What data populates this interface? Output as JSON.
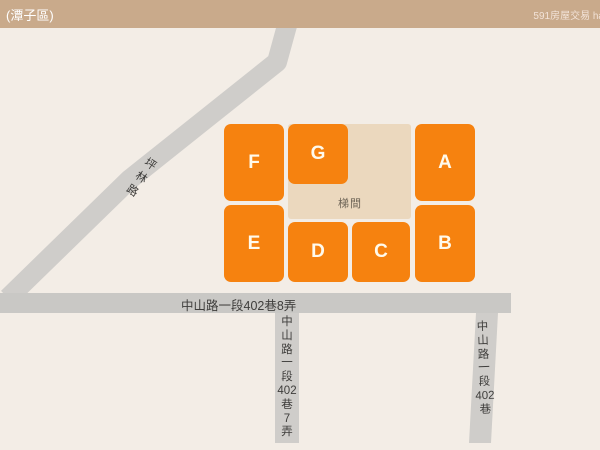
{
  "header": {
    "title": "(潭子區)",
    "watermark": "591房屋交易 ha"
  },
  "map": {
    "stairwell_label": "梯間",
    "blocks": [
      {
        "id": "F",
        "label": "F",
        "x": 224,
        "y": 124,
        "w": 60,
        "h": 77
      },
      {
        "id": "G",
        "label": "G",
        "x": 288,
        "y": 124,
        "w": 60,
        "h": 60
      },
      {
        "id": "A",
        "label": "A",
        "x": 415,
        "y": 124,
        "w": 60,
        "h": 77
      },
      {
        "id": "E",
        "label": "E",
        "x": 224,
        "y": 205,
        "w": 60,
        "h": 77
      },
      {
        "id": "D",
        "label": "D",
        "x": 288,
        "y": 222,
        "w": 60,
        "h": 60
      },
      {
        "id": "C",
        "label": "C",
        "x": 352,
        "y": 222,
        "w": 58,
        "h": 60
      },
      {
        "id": "B",
        "label": "B",
        "x": 415,
        "y": 205,
        "w": 60,
        "h": 77
      }
    ],
    "roads": {
      "diagonal": {
        "name": "坪林路",
        "chars": [
          "坪",
          "林",
          "路"
        ]
      },
      "horizontal": {
        "name": "中山路一段402巷8弄"
      },
      "vertical_left": {
        "name": "中山路一段402巷7弄",
        "chars": [
          "中",
          "山",
          "路",
          "一",
          "段",
          "402",
          "巷",
          "7",
          "弄"
        ]
      },
      "vertical_right": {
        "name": "中山路一段402巷",
        "chars": [
          "中",
          "山",
          "路",
          "一",
          "段",
          "402",
          "巷"
        ]
      }
    }
  },
  "colors": {
    "bar_bg": "#C9AA8B",
    "bar_text": "#FFFFFF",
    "watermark": "#F2E3D8",
    "bg": "#F3EDE6",
    "orange": "#F6820F",
    "block_text": "#FFFAEC",
    "stair_bg": "#EBD8BE",
    "stair_text": "#6E6557",
    "road": "#CFCDCA",
    "road_h": "#C9C8C5",
    "label": "#3E3D3B"
  }
}
